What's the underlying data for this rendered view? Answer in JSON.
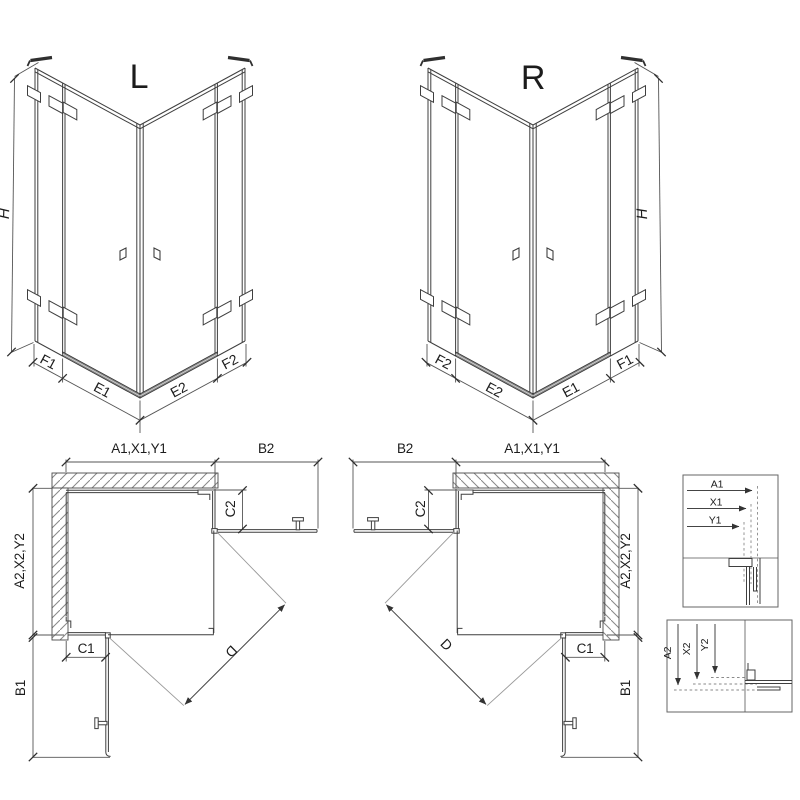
{
  "drawing": {
    "iso_left": {
      "label": "L",
      "h": "H",
      "f1": "F1",
      "e1": "E1",
      "e2": "E2",
      "f2": "F2"
    },
    "iso_right": {
      "label": "R",
      "h": "H",
      "f1": "F1",
      "e1": "E1",
      "e2": "E2",
      "f2": "F2"
    },
    "plan_left": {
      "width_top": "A1,X1,Y1",
      "b2": "B2",
      "c2": "C2",
      "depth_side": "A2,X2,Y2",
      "c1": "C1",
      "b1": "B1",
      "d": "D"
    },
    "plan_right": {
      "width_top": "A1,X1,Y1",
      "b2": "B2",
      "c2": "C2",
      "depth_side": "A2,X2,Y2",
      "c1": "C1",
      "b1": "B1",
      "d": "D"
    },
    "detail_top": {
      "a1": "A1",
      "x1": "X1",
      "y1": "Y1"
    },
    "detail_bottom": {
      "a2": "A2",
      "x2": "X2",
      "y2": "Y2"
    },
    "colors": {
      "line": "#3f3f3f",
      "dim": "#555555",
      "hatch": "#888888",
      "threshold": "#808080",
      "swing": "#999999",
      "background": "#ffffff"
    }
  }
}
